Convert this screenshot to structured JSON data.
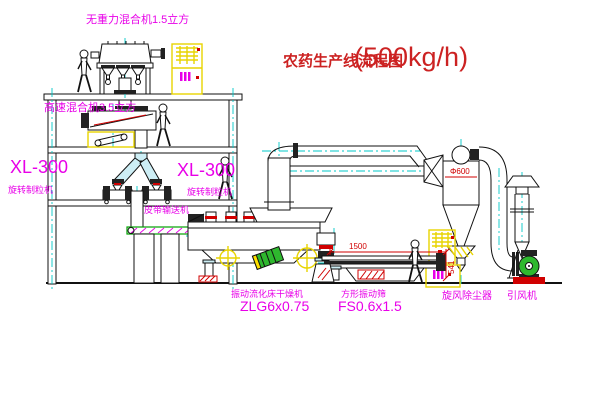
{
  "title": {
    "main": "农药生产线流程图",
    "capacity": "(500kg/h)"
  },
  "labels": {
    "top_mixer": "无重力混合机1.5立方",
    "second_mixer": "高速混合机3.5立方",
    "granulator_left_model": "XL-300",
    "granulator_left_name": "旋转制粒机",
    "granulator_right_model": "XL-300",
    "granulator_right_name": "旋转制粒机",
    "belt_conveyor": "皮带输送机",
    "dryer_name": "振动流化床干燥机",
    "dryer_model": "ZLG6x0.75",
    "sieve_name": "方形振动筛",
    "sieve_model": "FS0.6x1.5",
    "cyclone": "旋风除尘器",
    "fan": "引风机"
  },
  "dimensions": {
    "cyclone_diameter": "Φ600",
    "sieve_length": "1500",
    "sieve_height": "541"
  },
  "colors": {
    "label_magenta": "#e800e8",
    "title_red": "#cc2222",
    "dim_red": "#d00000",
    "centerline_cyan": "#00c8c8",
    "cabinet_yellow": "#f0e000",
    "machine_green": "#2eb82e",
    "conveyor_green": "#00a000"
  }
}
